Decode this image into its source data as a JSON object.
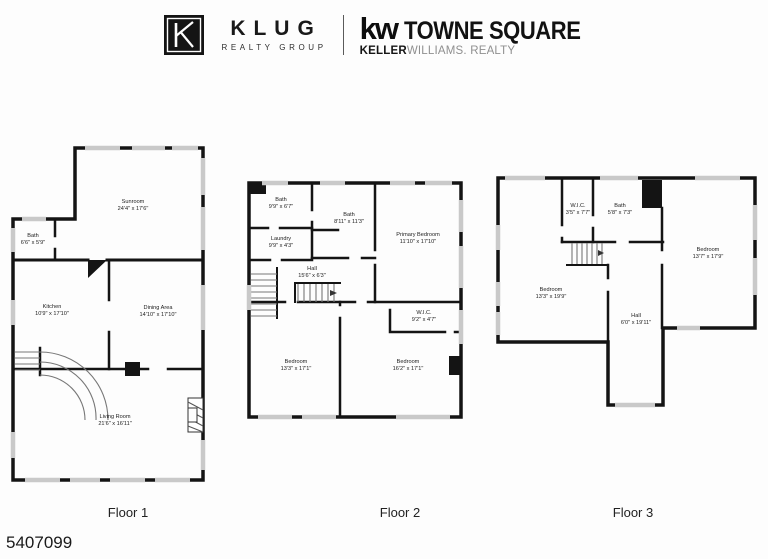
{
  "header": {
    "klug": {
      "letters": "KLUG",
      "tagline": "REALTY GROUP"
    },
    "kw": {
      "mark": "kw",
      "name": "TOWNE SQUARE",
      "brand_bold": "KELLER",
      "brand_light": "WILLIAMS. REALTY"
    }
  },
  "floors": [
    {
      "label": "Floor 1",
      "rooms": [
        {
          "name": "Sunroom",
          "dims": "24'4\" x 17'6\""
        },
        {
          "name": "Bath",
          "dims": "6'6\" x 5'9\""
        },
        {
          "name": "Kitchen",
          "dims": "10'9\" x 17'10\""
        },
        {
          "name": "Dining Area",
          "dims": "14'10\" x 17'10\""
        },
        {
          "name": "Living Room",
          "dims": "21'6\" x 16'11\""
        }
      ]
    },
    {
      "label": "Floor 2",
      "rooms": [
        {
          "name": "Bath",
          "dims": "9'9\" x 6'7\""
        },
        {
          "name": "Bath",
          "dims": "8'11\" x 11'3\""
        },
        {
          "name": "Laundry",
          "dims": "9'9\" x 4'3\""
        },
        {
          "name": "Primary Bedroom",
          "dims": "11'10\" x 17'10\""
        },
        {
          "name": "Hall",
          "dims": "15'6\" x 6'3\""
        },
        {
          "name": "W.I.C.",
          "dims": "9'2\" x 4'7\""
        },
        {
          "name": "Bedroom",
          "dims": "13'3\" x 17'1\""
        },
        {
          "name": "Bedroom",
          "dims": "16'2\" x 17'1\""
        }
      ]
    },
    {
      "label": "Floor 3",
      "rooms": [
        {
          "name": "W.I.C.",
          "dims": "3'5\" x 7'7\""
        },
        {
          "name": "Bath",
          "dims": "5'8\" x 7'3\""
        },
        {
          "name": "Bedroom",
          "dims": "13'7\" x 17'9\""
        },
        {
          "name": "Bedroom",
          "dims": "13'3\" x 19'9\""
        },
        {
          "name": "Hall",
          "dims": "6'0\" x 19'11\""
        }
      ]
    }
  ],
  "footer": {
    "listing_id": "5407099"
  },
  "colors": {
    "wall": "#141414",
    "window": "#c9c9c9",
    "background": "#fdfdfd"
  }
}
